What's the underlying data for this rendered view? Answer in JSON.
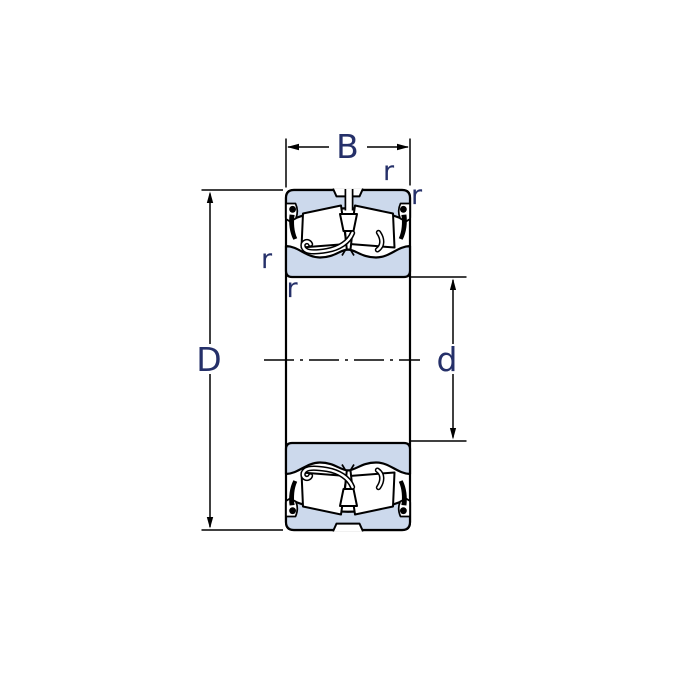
{
  "diagram": {
    "labels": {
      "width": "B",
      "outer_diameter": "D",
      "bore_diameter": "d",
      "fillet_top": "r",
      "fillet_top_corner": "r",
      "fillet_left": "r",
      "fillet_bottom_left": "r"
    },
    "colors": {
      "ring_fill": "#ccd9ec",
      "line": "#000000",
      "label_text": "#253069",
      "background": "#ffffff"
    }
  }
}
